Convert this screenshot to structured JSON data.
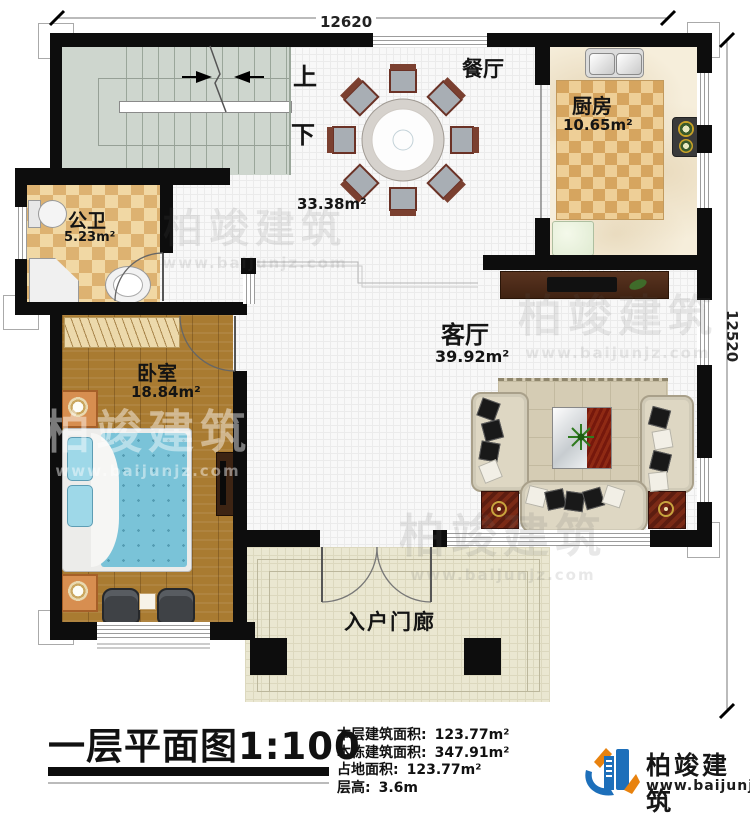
{
  "dimensions": {
    "top": "12620",
    "right": "12520"
  },
  "stairs": {
    "up": "上",
    "down": "下"
  },
  "rooms": {
    "dining": {
      "name": "餐厅",
      "area": "33.38m²"
    },
    "kitchen": {
      "name": "厨房",
      "area": "10.65m²"
    },
    "bathroom": {
      "name": "公卫",
      "area": "5.23m²"
    },
    "bedroom": {
      "name": "卧室",
      "area": "18.84m²"
    },
    "living": {
      "name": "客厅",
      "area": "39.92m²"
    },
    "porch": {
      "name": "入户门廊"
    }
  },
  "title": "一层平面图1:100",
  "info": {
    "lines": [
      {
        "label": "本层建筑面积:",
        "value": "123.77m²"
      },
      {
        "label": "本栋建筑面积:",
        "value": "347.91m²"
      },
      {
        "label": "占地面积:",
        "value": "123.77m²"
      },
      {
        "label": "层高:",
        "value": "3.6m"
      }
    ]
  },
  "logo": {
    "name": "柏竣建筑",
    "url": "www.baijunjz.com"
  },
  "watermark": {
    "text": "柏竣建筑",
    "url": "www.baijunjz.com"
  },
  "colors": {
    "wall": "#0d0d0d",
    "logo_blue": "#1d6fba",
    "logo_orange": "#e8820e",
    "bed_blue": "#7ac3d8"
  }
}
